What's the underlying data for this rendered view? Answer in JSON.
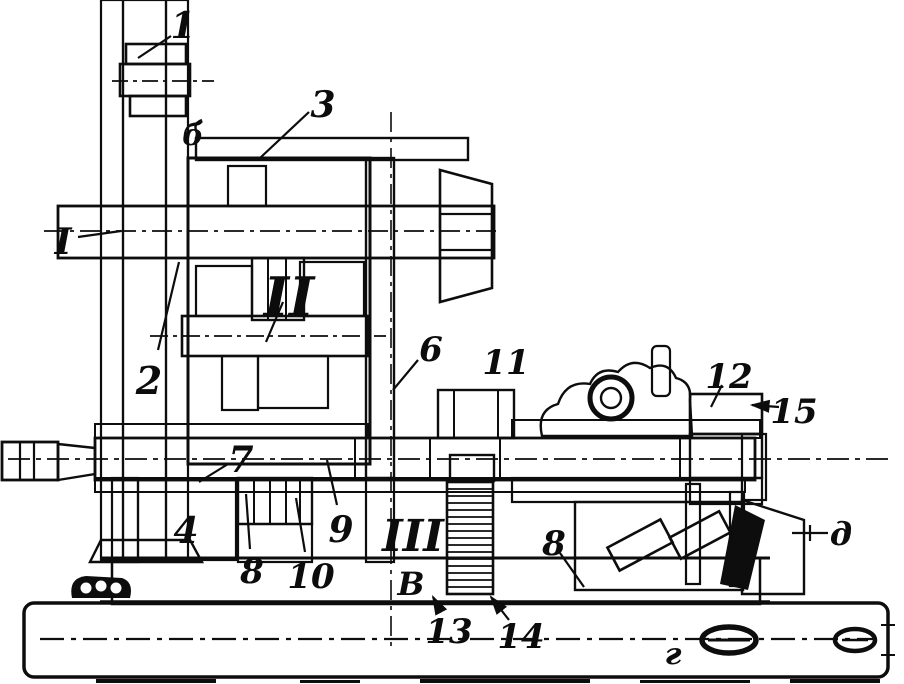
{
  "figure": {
    "kind": "technical-sectional-drawing",
    "description": "Sectional view of a machine-tool feed gearbox on a bed, scanned line art",
    "background_color": "#ffffff",
    "ink_color": "#0d0d0d"
  },
  "labels": [
    {
      "name": "part-1",
      "kind": "part",
      "text": "1",
      "x": 183,
      "y": 38,
      "size": 36,
      "leader": [
        171,
        36,
        138,
        58
      ],
      "arrow": false
    },
    {
      "name": "part-2",
      "kind": "part",
      "text": "2",
      "x": 149,
      "y": 394,
      "size": 38,
      "leader": [
        158,
        350,
        179,
        262
      ],
      "arrow": false
    },
    {
      "name": "part-3",
      "kind": "part",
      "text": "3",
      "x": 323,
      "y": 117,
      "size": 36,
      "leader": [
        309,
        112,
        260,
        158
      ],
      "arrow": false
    },
    {
      "name": "part-4",
      "kind": "part",
      "text": "4",
      "x": 186,
      "y": 543,
      "size": 36,
      "leader": null,
      "arrow": false
    },
    {
      "name": "part-6",
      "kind": "part",
      "text": "6",
      "x": 431,
      "y": 361,
      "size": 34,
      "leader": [
        418,
        360,
        393,
        390
      ],
      "arrow": false
    },
    {
      "name": "part-7",
      "kind": "part",
      "text": "7",
      "x": 241,
      "y": 472,
      "size": 36,
      "leader": [
        228,
        464,
        199,
        482
      ],
      "arrow": false
    },
    {
      "name": "part-8a",
      "kind": "part",
      "text": "8",
      "x": 252,
      "y": 583,
      "size": 34,
      "leader": [
        250,
        549,
        246,
        494
      ],
      "arrow": false
    },
    {
      "name": "part-8b",
      "kind": "part",
      "text": "8",
      "x": 554,
      "y": 555,
      "size": 34,
      "leader": [
        560,
        553,
        584,
        587
      ],
      "arrow": false
    },
    {
      "name": "part-9",
      "kind": "part",
      "text": "9",
      "x": 341,
      "y": 542,
      "size": 36,
      "leader": [
        337,
        505,
        327,
        460
      ],
      "arrow": false
    },
    {
      "name": "part-10",
      "kind": "part",
      "text": "10",
      "x": 311,
      "y": 588,
      "size": 34,
      "leader": [
        305,
        552,
        296,
        498
      ],
      "arrow": false
    },
    {
      "name": "part-11",
      "kind": "part",
      "text": "11",
      "x": 506,
      "y": 374,
      "size": 34,
      "leader": null,
      "arrow": false
    },
    {
      "name": "part-12",
      "kind": "part",
      "text": "12",
      "x": 729,
      "y": 388,
      "size": 34,
      "leader": [
        722,
        385,
        711,
        407
      ],
      "arrow": false
    },
    {
      "name": "part-13",
      "kind": "part",
      "text": "13",
      "x": 449,
      "y": 643,
      "size": 34,
      "leader": [
        441,
        612,
        433,
        597
      ],
      "arrow": true
    },
    {
      "name": "part-14",
      "kind": "part",
      "text": "14",
      "x": 521,
      "y": 648,
      "size": 34,
      "leader": [
        509,
        620,
        491,
        597
      ],
      "arrow": true
    },
    {
      "name": "part-15",
      "kind": "part",
      "text": "15",
      "x": 794,
      "y": 423,
      "size": 34,
      "leader": [
        779,
        407,
        752,
        405
      ],
      "arrow": true
    },
    {
      "name": "shaft-I",
      "kind": "shaft",
      "text": "I",
      "x": 63,
      "y": 254,
      "size": 36,
      "leader": [
        78,
        237,
        121,
        231
      ],
      "arrow": false
    },
    {
      "name": "shaft-II",
      "kind": "shaft",
      "text": "II",
      "x": 289,
      "y": 316,
      "size": 54,
      "leader": [
        283,
        302,
        266,
        342
      ],
      "arrow": false
    },
    {
      "name": "shaft-III",
      "kind": "shaft",
      "text": "III",
      "x": 413,
      "y": 551,
      "size": 44,
      "leader": null,
      "arrow": false
    },
    {
      "name": "point-b",
      "kind": "point",
      "text": "б",
      "x": 193,
      "y": 145,
      "size": 30,
      "leader": null,
      "arrow": false
    },
    {
      "name": "point-v",
      "kind": "point",
      "text": "В",
      "x": 411,
      "y": 595,
      "size": 32,
      "leader": null,
      "arrow": false
    },
    {
      "name": "point-g",
      "kind": "point",
      "text": "г",
      "x": 673,
      "y": 664,
      "size": 30,
      "leader": null,
      "arrow": false
    },
    {
      "name": "point-d",
      "kind": "point",
      "text": "д",
      "x": 841,
      "y": 545,
      "size": 32,
      "leader": null,
      "arrow": false
    }
  ]
}
